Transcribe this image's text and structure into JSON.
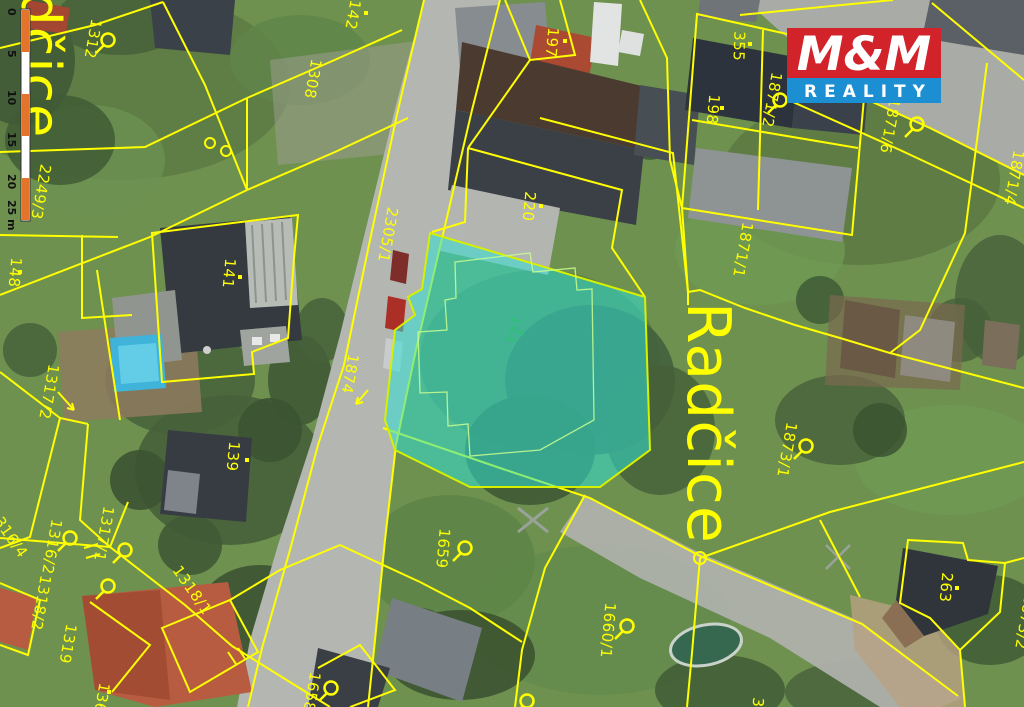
{
  "map": {
    "place_label_left": "Radčice",
    "place_label_main": "Radčice",
    "highlight_color": "#2fe0d4",
    "parcel_line_color": "#ffff00",
    "parcels": [
      {
        "label": "1312"
      },
      {
        "label": "142"
      },
      {
        "label": "1308"
      },
      {
        "label": "197"
      },
      {
        "label": "355"
      },
      {
        "label": "198"
      },
      {
        "label": "1871/2"
      },
      {
        "label": "1871/6"
      },
      {
        "label": "1871/4"
      },
      {
        "label": "1871/1"
      },
      {
        "label": "2305/1"
      },
      {
        "label": "1874"
      },
      {
        "label": "141"
      },
      {
        "label": "148"
      },
      {
        "label": "220"
      },
      {
        "label": "144"
      },
      {
        "label": "139"
      },
      {
        "label": "1317/2"
      },
      {
        "label": "1316/4"
      },
      {
        "label": "1316/2"
      },
      {
        "label": "1317/1"
      },
      {
        "label": "1318/2"
      },
      {
        "label": "1319"
      },
      {
        "label": "136"
      },
      {
        "label": "1318/1"
      },
      {
        "label": "1658"
      },
      {
        "label": "1659"
      },
      {
        "label": "1660/1"
      },
      {
        "label": "263"
      },
      {
        "label": "1873/1"
      },
      {
        "label": "1873/2"
      },
      {
        "label": "2249/3"
      },
      {
        "label": "3"
      }
    ]
  },
  "logo": {
    "mm": "M&M",
    "reality": "REALITY",
    "red": "#d2232a",
    "blue": "#1b8fd2"
  },
  "scalebar": {
    "ticks": [
      "0",
      "5",
      "10",
      "15",
      "20"
    ],
    "end_label": "25 m",
    "bar_orange": "#e4732c"
  }
}
